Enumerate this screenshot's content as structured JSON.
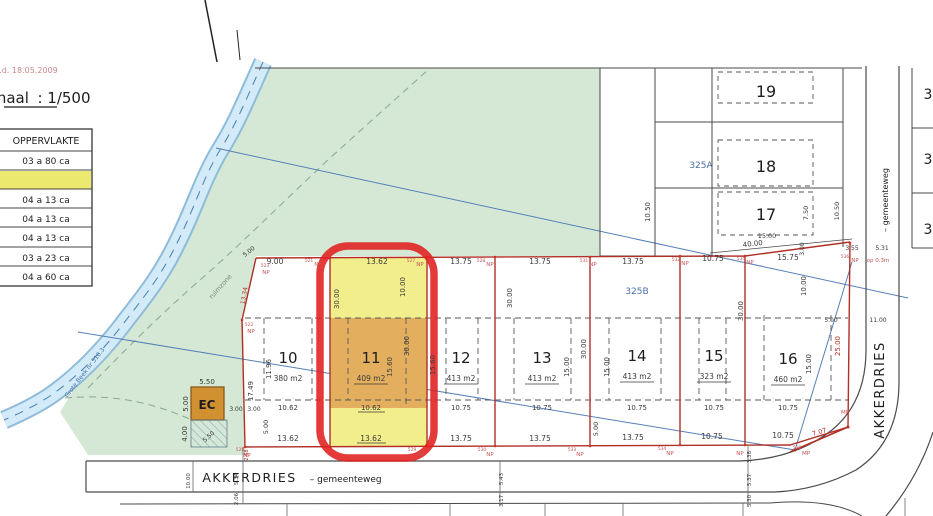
{
  "header": {
    "ref": "13004/60385.7  d.d.  18.05.2009",
    "scale_label": "Schaal",
    "scale_value": ":  1/500"
  },
  "area_table": {
    "header": "OPPERVLAKTE",
    "rows": [
      "03 a 80 ca",
      "",
      "04 a 13 ca",
      "04 a 13 ca",
      "04 a 13 ca",
      "03 a 23 ca",
      "04 a 60 ca"
    ]
  },
  "lots": [
    {
      "no": "10",
      "area": "380 m2",
      "w_top": "9.00",
      "w_mid": "10.62",
      "w_bot": "13.62"
    },
    {
      "no": "11",
      "area": "409 m2",
      "w_top": "13.62",
      "w_mid": "10.62",
      "w_bot": "13.62"
    },
    {
      "no": "12",
      "area": "413 m2",
      "w_top": "13.75",
      "w_mid": "10.75",
      "w_bot": "13.75"
    },
    {
      "no": "13",
      "area": "413 m2",
      "w_top": "13.75",
      "w_mid": "10.75",
      "w_bot": "13.75"
    },
    {
      "no": "14",
      "area": "413 m2",
      "w_top": "13.75",
      "w_mid": "10.75",
      "w_bot": "13.75"
    },
    {
      "no": "15",
      "area": "323 m2",
      "w_top": "10.75",
      "w_mid": "10.75",
      "w_bot": "10.75"
    },
    {
      "no": "16",
      "area": "460 m2",
      "w_top": "15.75",
      "w_mid": "10.75",
      "w_bot": "10.75"
    }
  ],
  "upper_lots": [
    {
      "no": "19"
    },
    {
      "no": "18"
    },
    {
      "no": "17"
    }
  ],
  "edge_lots": [
    "3",
    "3",
    "3"
  ],
  "cadastral": {
    "left": "325A",
    "right": "325B"
  },
  "streets": {
    "bottom_name": "AKKERDRIES",
    "bottom_type": "–  gemeenteweg",
    "right_name": "AKKERDRIES",
    "right_type": "–  gemeenteweg"
  },
  "stream": {
    "label": "openbare waterloop  Grote Beek  nr 510.3"
  },
  "zones": {
    "buffer": "ruimzone",
    "ec": "EC"
  },
  "markers": {
    "np": "NP",
    "mp": "MP",
    "note": "op 0.3m",
    "top_ids": [
      "521",
      "527",
      "528",
      "531",
      "532",
      "535",
      "536"
    ],
    "bot_ids": [
      "526",
      "529",
      "530",
      "533",
      "534",
      "538"
    ],
    "left_ids": [
      "523",
      "522"
    ]
  },
  "dims": {
    "v206": "2.06",
    "v268": "2.68",
    "v300": "3.00",
    "v317": "3.17",
    "v338": "3.38",
    "v355": "3.55",
    "v400": "4.00",
    "v500": "5.00",
    "v530": "5.30",
    "v531": "5.31",
    "v534": "5.34",
    "v537": "5.37",
    "v543": "5.43",
    "v550": "5.50",
    "v707": "7.07",
    "v750": "7.50",
    "v1000": "10.00",
    "v1050": "10.50",
    "v1100": "11.00",
    "v1196": "11.96",
    "v1334": "13.34",
    "v1500": "15.00",
    "v1560": "15.60",
    "v1749": "17.49",
    "v2500": "25.00",
    "v3000": "30.00",
    "v4000": "40.00"
  }
}
